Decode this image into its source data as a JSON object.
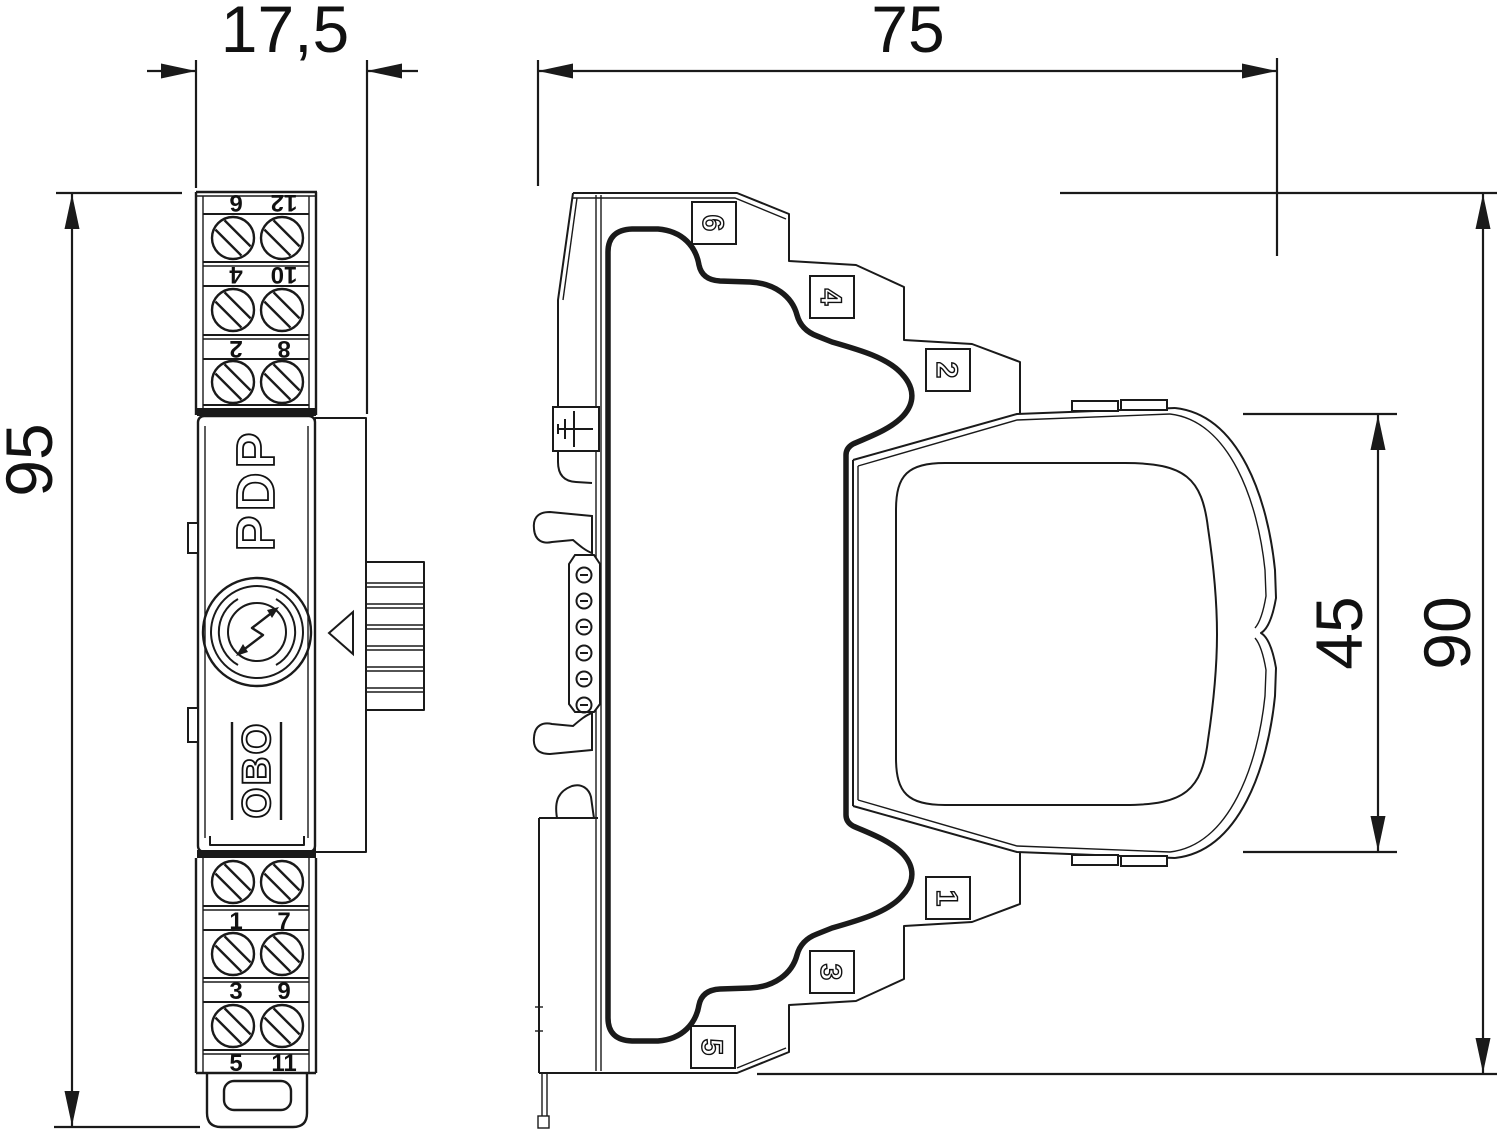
{
  "document": {
    "type": "technical-dimension-drawing",
    "colors": {
      "line": "#1a1a1a",
      "background": "#ffffff"
    }
  },
  "dimensions": {
    "front_width_mm": "17,5",
    "front_height_mm": "95",
    "side_depth_mm": "75",
    "module_height_mm": "45",
    "side_height_mm": "90"
  },
  "front_view": {
    "product_label": "PDP",
    "brand_label": "OBO",
    "top_terminals": {
      "rows": [
        [
          "6",
          "12"
        ],
        [
          "4",
          "10"
        ],
        [
          "2",
          "8"
        ]
      ]
    },
    "bottom_terminals": {
      "rows": [
        [
          "1",
          "7"
        ],
        [
          "3",
          "9"
        ],
        [
          "5",
          "11"
        ]
      ]
    }
  },
  "side_view": {
    "upper_markers": [
      "6",
      "4",
      "2"
    ],
    "lower_markers": [
      "1",
      "3",
      "5"
    ]
  },
  "icons": {
    "earth": "earth-ground-icon",
    "logo": "surge-lightning-logo"
  }
}
